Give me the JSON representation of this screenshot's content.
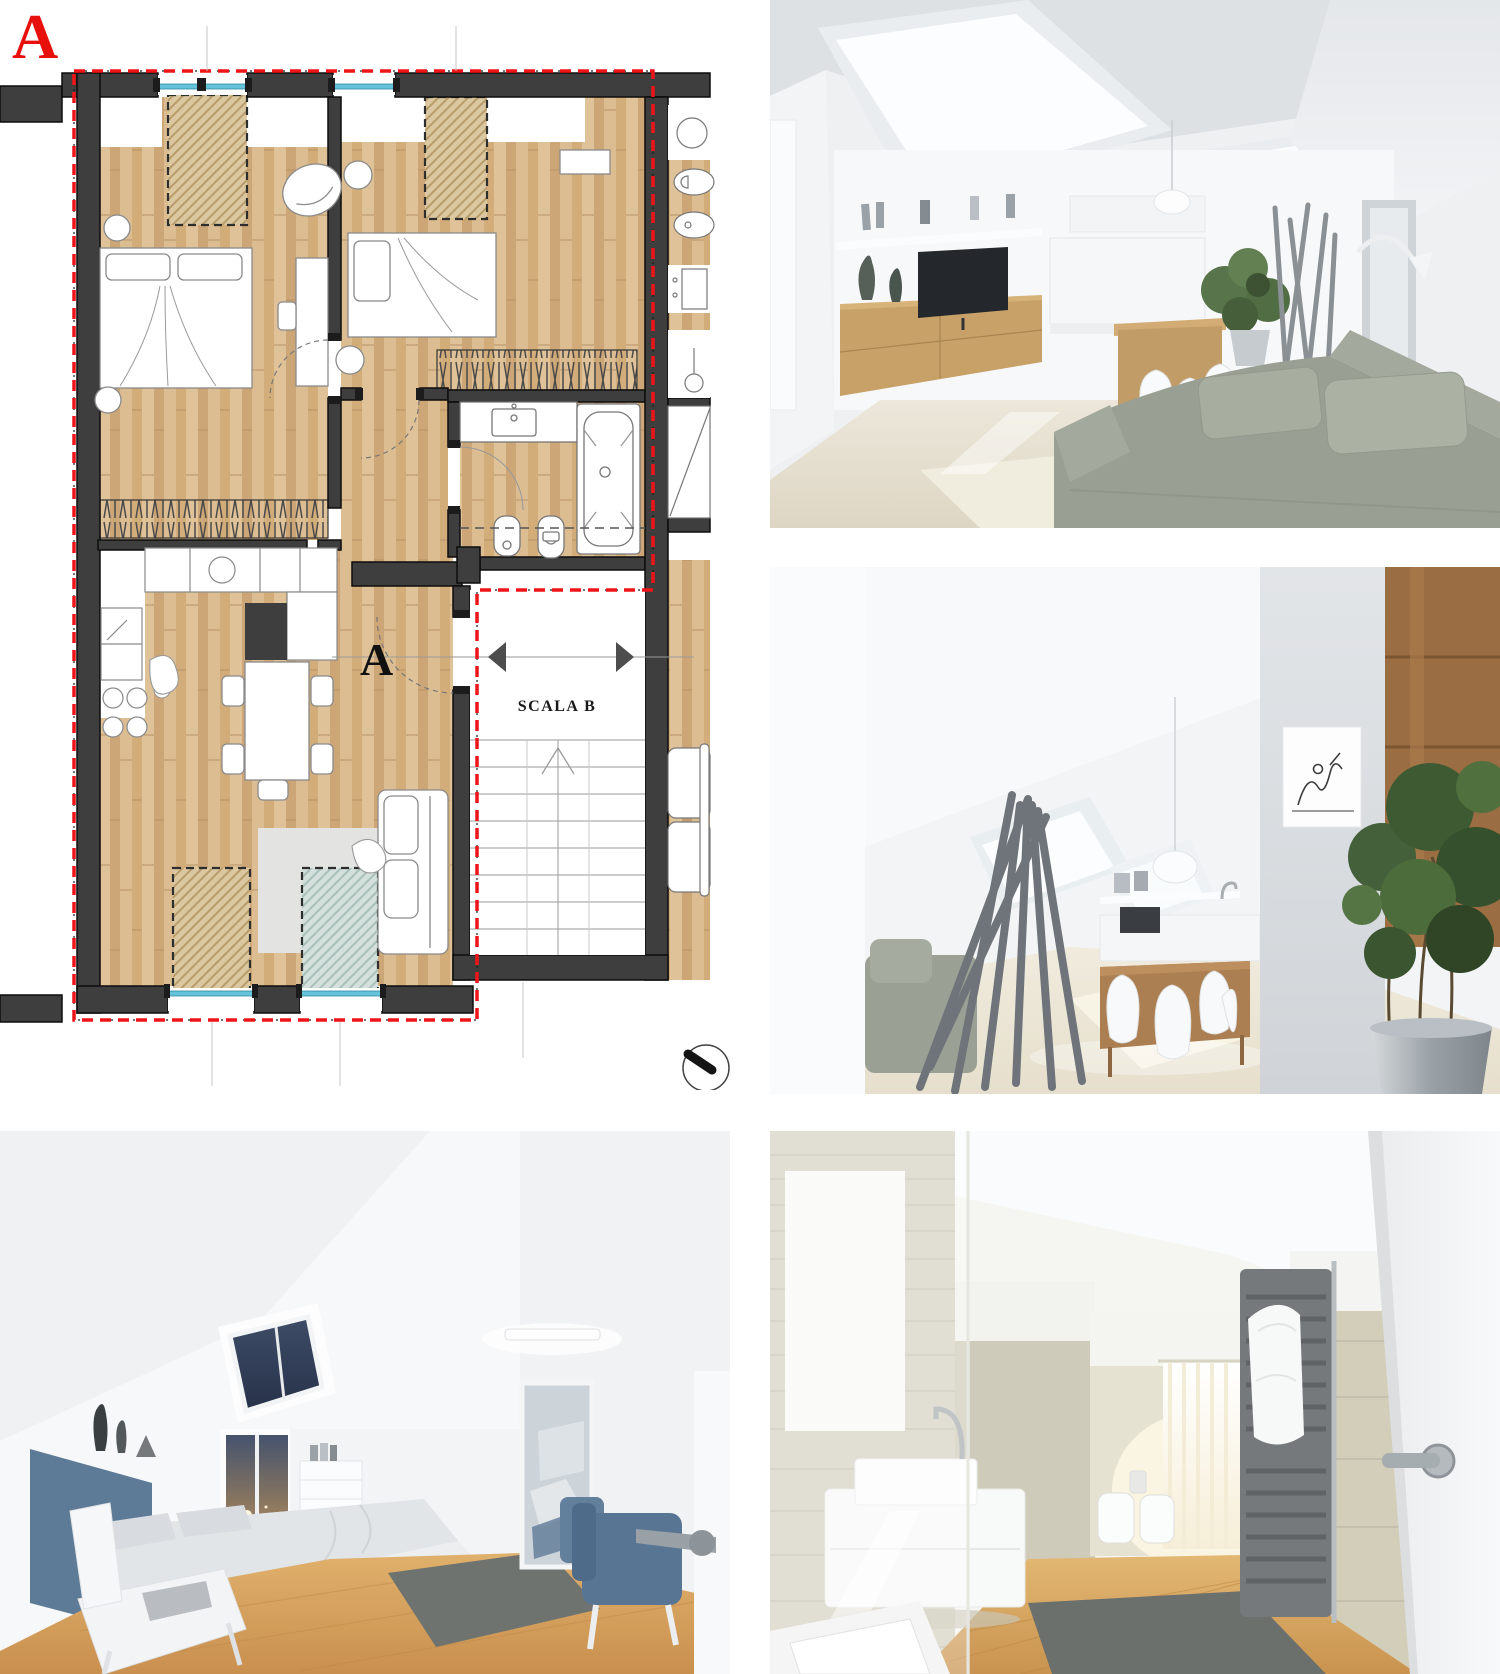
{
  "board": {
    "background": "#ffffff"
  },
  "floor_plan": {
    "plan_label": "A",
    "section_marker_label": "A",
    "stairwell_label": "SCALA B",
    "icons": {
      "north_arrow_icon": "circle-with-compass-needle",
      "section_cut_arrows_icon": "opposing-solid-triangles"
    },
    "colors": {
      "wall": "#3e3e3e",
      "apartment_outline_red": "#ef1418",
      "label_red": "#e8100c",
      "wood_floor": "#d9b98c",
      "window_glass": "#67c3da",
      "skylight_hatch_tan": "#dbc8a0",
      "skylight_hatch_blue": "#d3e0dc",
      "rug_gray": "#e3e4e1",
      "radiator_stroke": "#4a4a4a"
    }
  },
  "renders": [
    {
      "alt": "Attic living room render: skylights, oak sideboard with TV and vases, white kitchen, wood island with white chairs, plant, branch coat stand and grey corner sofa",
      "palette": {
        "floor": "#e8e3d4",
        "rug": "#f0edde",
        "sofa": "#99a093",
        "wood": "#c7a167"
      }
    },
    {
      "alt": "Attic dining room render: grey branch sculpture, sofa, roof windows, wood dining table with white Panton chairs, pendant lamp, line-art picture on pillar, oak wall panel and large potted plant",
      "palette": {
        "floor": "#ece6d6",
        "branches": "#6f747a",
        "plant": "#3e5a32",
        "wood_panel": "#9a6d42"
      }
    },
    {
      "alt": "Attic bedroom render: bed with white duvet and blue headboard bench, dormer skylight with evening sky, white chair with book, dresser, mirror, wall light and blue armchairs on warm wood floor with grey rug",
      "palette": {
        "floor": "#d2a05c",
        "headboard_blue": "#5d7a96",
        "armchair_blue": "#587694",
        "rug": "#6e7370"
      }
    },
    {
      "alt": "Bathroom render: travertine stone walls, glass shower, floating white vanity with vessel sink and tall faucet, wood floor with grey runner rug, dark towel radiator with white towel and open white door with steel handle",
      "palette": {
        "stone": "#d6d2c2",
        "floor": "#d2a25f",
        "rug": "#6b706d",
        "radiator": "#75797b"
      }
    }
  ]
}
